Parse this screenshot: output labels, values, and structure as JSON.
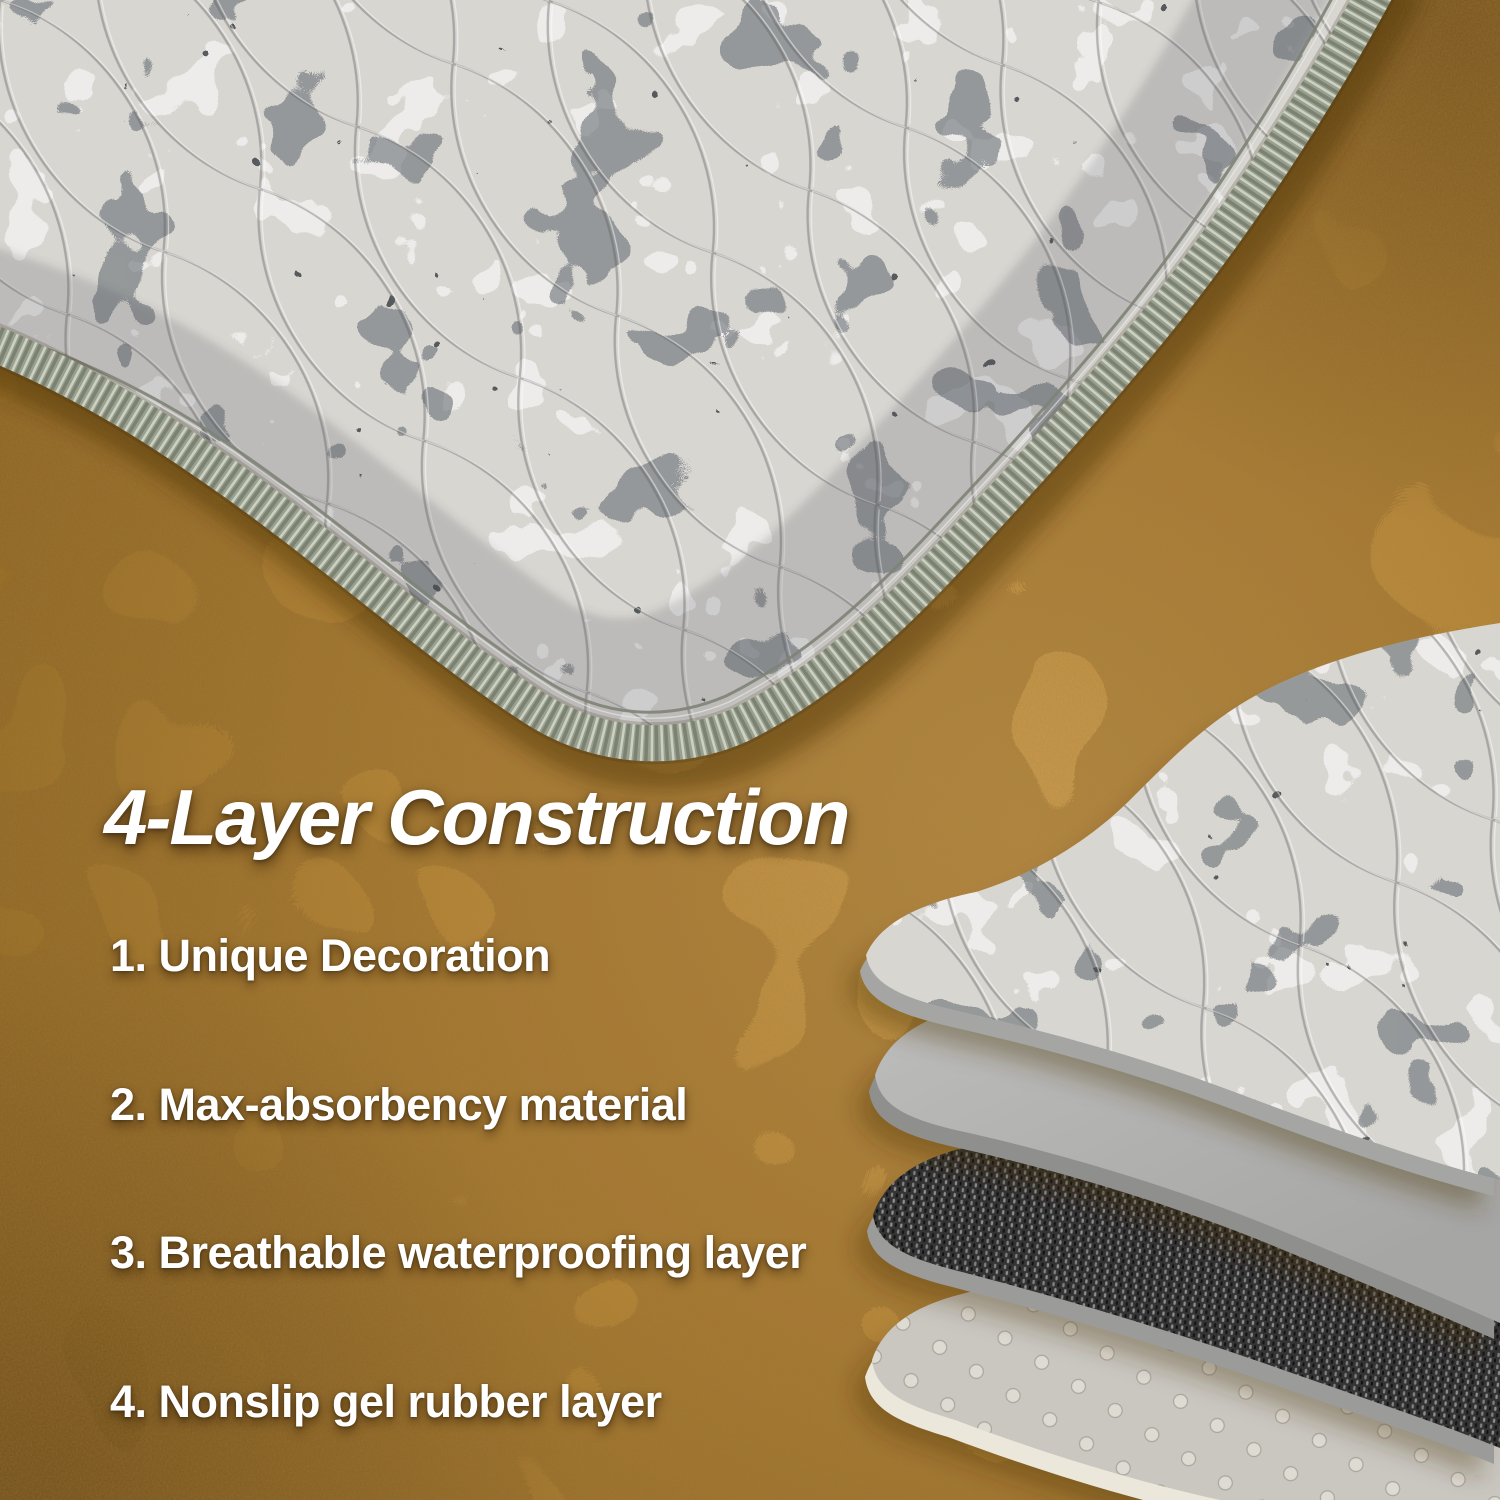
{
  "heading": {
    "text": "4-Layer Construction"
  },
  "features": [
    {
      "text": "1. Unique Decoration"
    },
    {
      "text": "2. Max-absorbency material"
    },
    {
      "text": "3. Breathable waterproofing layer"
    },
    {
      "text": "4. Nonslip gel rubber layer"
    }
  ],
  "diagram": {
    "layer_names": [
      "printed-quilted-fabric-layer",
      "absorbent-material-layer",
      "waterproof-woven-layer",
      "nonslip-gel-rubber-layer"
    ]
  },
  "colors": {
    "floor": "#b2802f",
    "floor_highlight": "#cb9a4a",
    "floor_shadow": "#7c5516",
    "fabric_base": "#d8d6d1",
    "pattern_dark": "#3f4448",
    "binding_sage": "#99a08f",
    "layer_gray": "#b7b7b5",
    "layer_dark_woven": "#3a3a3a",
    "layer_dotted": "#c9c7c0",
    "layer_rim_cream": "#ece7db",
    "text": "#ffffff"
  }
}
